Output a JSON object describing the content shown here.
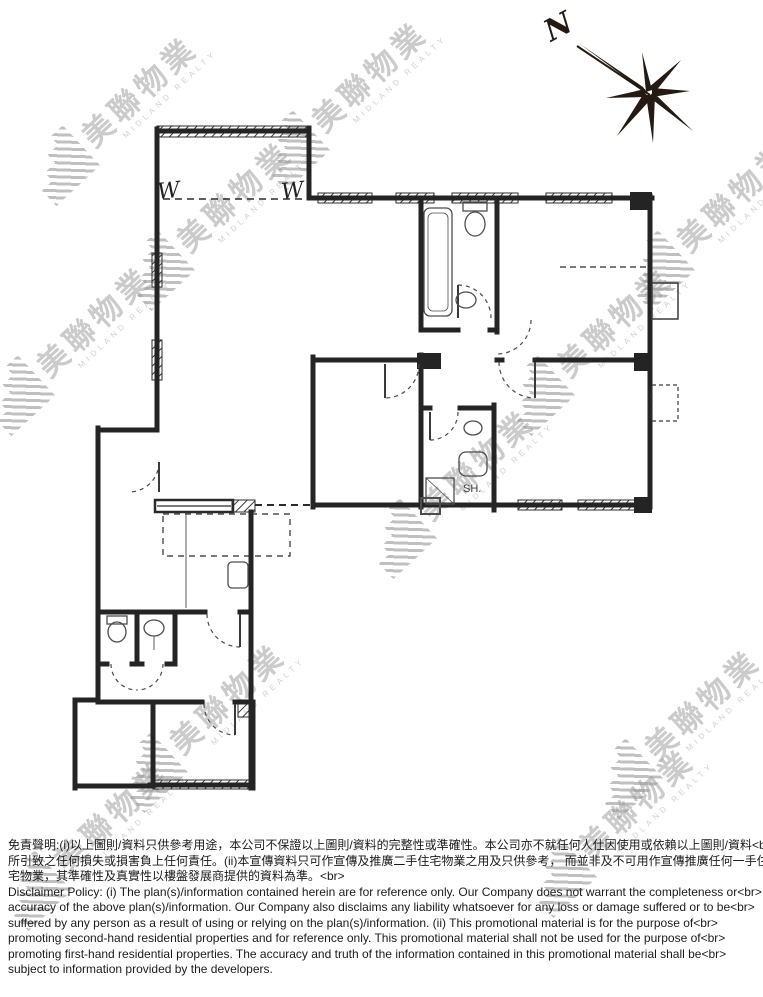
{
  "watermark": {
    "text_cn": "美聯物業",
    "text_en": "MIDLAND REALTY"
  },
  "compass": {
    "north_label": "N"
  },
  "plan": {
    "shower_label": "SH.",
    "window_label_left": "W",
    "window_label_right": "W"
  },
  "disclaimer": {
    "lines_zh": [
      "免責聲明:(i)以上圖則/資料只供參考用途，本公司不保證以上圖則/資料的完整性或準確性。本公司亦不就任何人仕因使用或依賴以上圖則/資料<br>",
      "所引致之任何損失或損害負上任何責任。(ii)本宣傳資料只可作宣傳及推廣二手住宅物業之用及只供參考， 而並非及不可用作宣傳推廣任何一手住<br>",
      "宅物業，其準確性及真實性以樓盤發展商提供的資料為準。<br>"
    ],
    "lines_en": [
      "Disclaimer Policy: (i) The plan(s)/information contained herein are for reference only. Our Company does not warrant the completeness or<br>",
      "accuracy of the above plan(s)/information. Our Company also disclaims any liability whatsoever for any loss or damage suffered or to be<br>",
      "suffered by any person as a result of using or relying on the plan(s)/information. (ii) This promotional material is for the purpose of<br>",
      "promoting second-hand residential properties and for reference only. This promotional material shall not be used for the purpose of<br>",
      "promoting first-hand residential properties. The accuracy and truth of the information contained in this promotional material shall be<br>",
      "subject to information provided by the developers."
    ]
  }
}
